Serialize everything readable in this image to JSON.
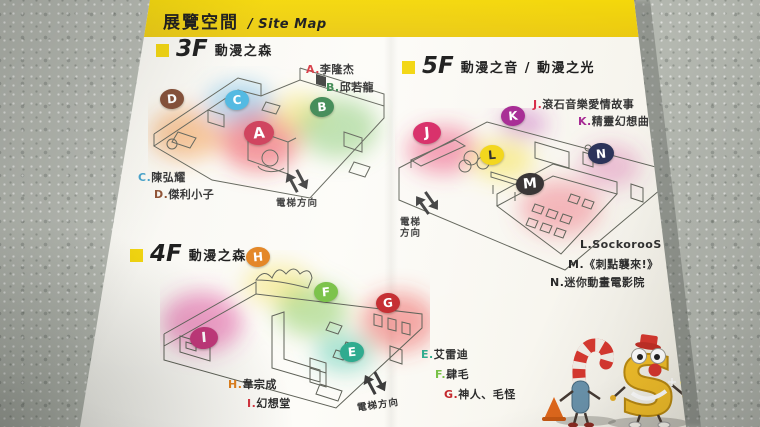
{
  "header": {
    "title_zh": "展覽空間",
    "title_en": "/ Site Map"
  },
  "colors": {
    "band_yellow": "#f2d405",
    "page_white": "#fbfaf5",
    "table_gray": "#b2b6ae"
  },
  "floors": {
    "f3": {
      "floor": "3F",
      "name": "動漫之森",
      "badges": [
        {
          "letter": "A",
          "color": "#cc3350"
        },
        {
          "letter": "B",
          "color": "#35834b"
        },
        {
          "letter": "C",
          "color": "#45b4e0"
        },
        {
          "letter": "D",
          "color": "#7d452c"
        }
      ],
      "legend": [
        {
          "prefix": "A.",
          "name": "李隆杰"
        },
        {
          "prefix": "B.",
          "name": "邱若龍"
        },
        {
          "prefix": "C.",
          "name": "陳弘耀"
        },
        {
          "prefix": "D.",
          "name": "傑利小子"
        }
      ],
      "elevator": "電梯方向"
    },
    "f4": {
      "floor": "4F",
      "name": "動漫之森",
      "badges": [
        {
          "letter": "H",
          "color": "#e2801b"
        },
        {
          "letter": "F",
          "color": "#76c043"
        },
        {
          "letter": "G",
          "color": "#c3262b"
        },
        {
          "letter": "I",
          "color": "#c03277"
        },
        {
          "letter": "E",
          "color": "#2aa98c"
        }
      ],
      "legend": [
        {
          "prefix": "H.",
          "name": "韋宗成"
        },
        {
          "prefix": "I.",
          "name": "幻想堂"
        },
        {
          "prefix": "E.",
          "name": "艾雷迪"
        },
        {
          "prefix": "F.",
          "name": "肆毛"
        },
        {
          "prefix": "G.",
          "name": "神人、毛怪"
        }
      ],
      "elevator": "電梯方向"
    },
    "f5": {
      "floor": "5F",
      "name": "動漫之音 / 動漫之光",
      "badges": [
        {
          "letter": "J",
          "color": "#d6215f"
        },
        {
          "letter": "K",
          "color": "#a3218f"
        },
        {
          "letter": "L",
          "color": "#f2d40e"
        },
        {
          "letter": "M",
          "color": "#2e2a2b"
        },
        {
          "letter": "N",
          "color": "#232a52"
        }
      ],
      "legend_top": [
        {
          "prefix": "J.",
          "name": "滾石音樂愛情故事"
        },
        {
          "prefix": "K.",
          "name": "精靈幻想曲"
        }
      ],
      "legend_bottom": [
        {
          "prefix": "L.",
          "name": "SockorooS"
        },
        {
          "prefix": "M.",
          "name": "《刺點襲來!》"
        },
        {
          "prefix": "N.",
          "name": "迷你動畫電影院"
        }
      ],
      "elevator_line1": "電梯",
      "elevator_line2": "方向"
    }
  }
}
